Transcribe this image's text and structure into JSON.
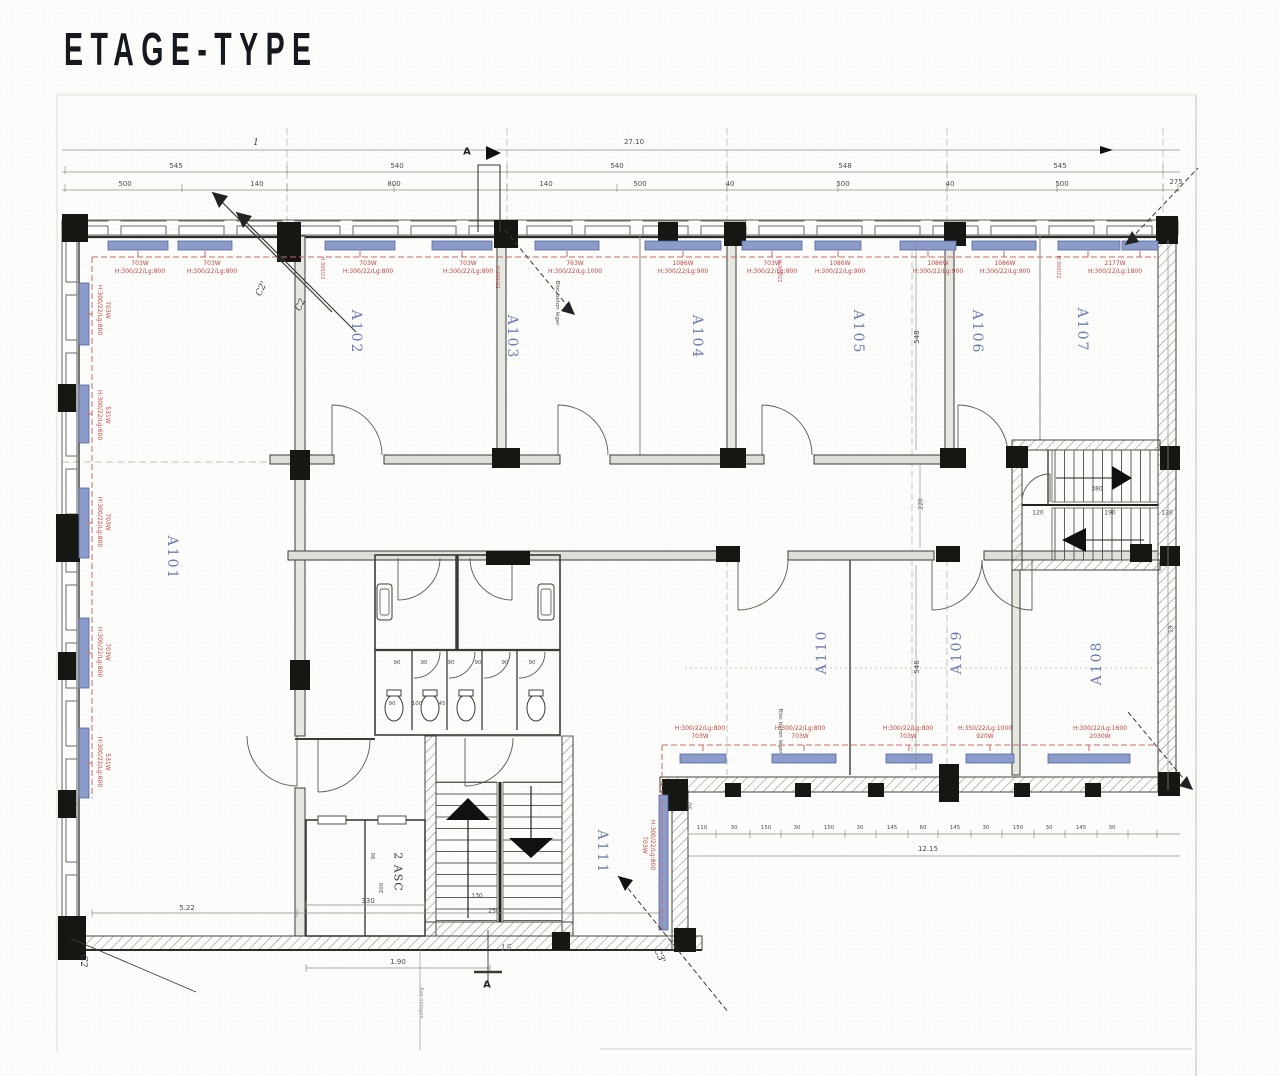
{
  "title": "ETAGE-TYPE",
  "rooms": {
    "a101": "A101",
    "a102": "A102",
    "a103": "A103",
    "a104": "A104",
    "a105": "A105",
    "a106": "A106",
    "a107": "A107",
    "a108": "A108",
    "a109": "A109",
    "a110": "A110",
    "a111": "A111",
    "elevators": "2 ASC"
  },
  "dims": {
    "total_width": "27.10",
    "axis": "1",
    "bays": [
      "545",
      "540",
      "540",
      "548",
      "545"
    ],
    "subs": [
      "500",
      "140",
      "800",
      "140",
      "500",
      "40",
      "500",
      "40",
      "500",
      "275"
    ],
    "chain_bottom": [
      "110",
      "30",
      "150",
      "30",
      "150",
      "30",
      "145",
      "60",
      "145",
      "30",
      "150",
      "30",
      "145",
      "30"
    ],
    "total_bottom": "12.15",
    "left_width": "5.22",
    "elev_width": "330",
    "door_width": "1.90",
    "stair_a": "130",
    "stair_b": "250",
    "e90": "90",
    "e200": "200",
    "d50": "50",
    "v_top": "548",
    "v_bottom": "546",
    "v_mid": "220",
    "r19": "19",
    "rs_len": "380",
    "rs_a": "120",
    "rs_b": "190",
    "rs_c": "120",
    "wc": [
      "90",
      "90",
      "90",
      "90",
      "90",
      "90"
    ],
    "wc_sub": [
      "90",
      "100",
      "45"
    ],
    "hand": "15"
  },
  "sections": {
    "c2_top_a": "C2'",
    "c2_top_b": "C2",
    "c2_bottom": "C2",
    "c3_bottom": "C3'",
    "a_top": "A",
    "a_bottom": "A"
  },
  "radiators": {
    "top": [
      {
        "power": "703W",
        "size": "H:300/22/Lg:800"
      },
      {
        "power": "703W",
        "size": "H:300/22/Lg:800"
      },
      {
        "power": "703W",
        "size": "H:300/22/Lg:800"
      },
      {
        "power": "703W",
        "size": "H:300/22/Lg:800"
      },
      {
        "power": "763W",
        "size": "H:300/22/Lg:1000"
      },
      {
        "power": "1086W",
        "size": "H:300/22/Lg:900"
      },
      {
        "power": "703W",
        "size": "H:300/22/Lg:800"
      },
      {
        "power": "1086W",
        "size": "H:300/22/Lg:900"
      },
      {
        "power": "1086W",
        "size": "H:300/22/Lg:900"
      },
      {
        "power": "1086W",
        "size": "H:300/22/Lg:900"
      },
      {
        "power": "2177W",
        "size": "H:300/22/Lg:1800"
      }
    ],
    "bottom": [
      {
        "size": "H:300/22/Lg:800",
        "power": "703W"
      },
      {
        "size": "H:300/22/Lg:800",
        "power": "703W"
      },
      {
        "size": "H:300/22/Lg:800",
        "power": "703W"
      },
      {
        "size": "H:350/22/Lg:1000",
        "power": "920W"
      },
      {
        "size": "H:300/22/Lg:1600",
        "power": "2030W"
      }
    ],
    "left": [
      {
        "power": "703W",
        "size": "H:300/22/Lg:800"
      },
      {
        "power": "531W",
        "size": "H:300/22/Lg:600"
      },
      {
        "power": "703W",
        "size": "H:300/22/Lg:800"
      },
      {
        "power": "703W",
        "size": "H:300/22/Lg:800"
      },
      {
        "power": "531W",
        "size": "H:300/22/Lg:600"
      }
    ],
    "a111": {
      "size": "H:300/22/Lg:800",
      "power": "703W"
    },
    "tag": "H:300/22"
  },
  "notes": {
    "bloc_a": "Bloc béton léger",
    "bloc_b": "Bloc béton léger",
    "axe": "Axe mitoyen"
  }
}
